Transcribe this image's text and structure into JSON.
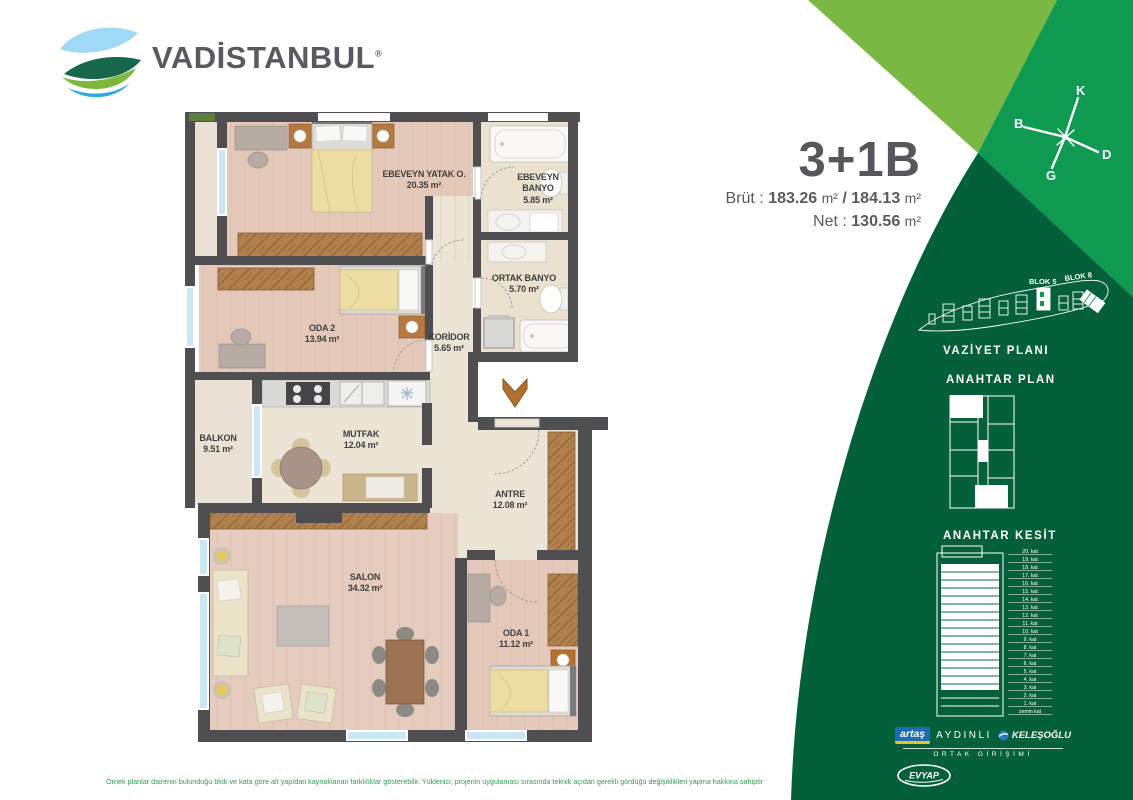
{
  "brand": {
    "name": "VADİSTANBUL",
    "registered": "®"
  },
  "unit": {
    "title": "3+1B",
    "brut_label": "Brüt :",
    "brut_area_1": "183.26",
    "separator": "/",
    "brut_area_2": "184.13",
    "net_label": "Net :",
    "net_area": "130.56",
    "unit_suffix": "m²"
  },
  "compass": {
    "north": "K",
    "east": "D",
    "south": "G",
    "west": "B"
  },
  "site_plan": {
    "heading": "VAZİYET PLANI",
    "blok5": "BLOK 5",
    "blok8": "BLOK 8"
  },
  "key_plan": {
    "heading": "ANAHTAR PLAN"
  },
  "key_section": {
    "heading": "ANAHTAR KESİT",
    "floors": [
      "20. kat",
      "19. kat",
      "18. kat",
      "17. kat",
      "16. kat",
      "15. kat",
      "14. kat",
      "13. kat",
      "12. kat",
      "11. kat",
      "10. kat",
      "9. kat",
      "8. kat",
      "7. kat",
      "6. kat",
      "5. kat",
      "4. kat",
      "3. kat",
      "2. kat",
      "1. kat",
      "zemin kat"
    ]
  },
  "plan": {
    "rooms": [
      {
        "name": "EBEVEYN YATAK O.",
        "area": "20.35 m²"
      },
      {
        "name": "EBEVEYN BANYO",
        "area": "5.85 m²"
      },
      {
        "name": "ORTAK BANYO",
        "area": "5.70 m²"
      },
      {
        "name": "ODA 2",
        "area": "13.94 m²"
      },
      {
        "name": "KORİDOR",
        "area": "5.65 m²"
      },
      {
        "name": "BALKON",
        "area": "9.51 m²"
      },
      {
        "name": "MUTFAK",
        "area": "12.04 m²"
      },
      {
        "name": "ANTRE",
        "area": "12.08 m²"
      },
      {
        "name": "SALON",
        "area": "34.32 m²"
      },
      {
        "name": "ODA 1",
        "area": "11.12 m²"
      }
    ]
  },
  "partners": {
    "artas": "artaş",
    "aydinli": "AYDINLI",
    "kelesoglu": "KELEŞOĞLU",
    "joint": "ORTAK GİRİŞİMİ",
    "evyap": "EVYAP"
  },
  "footer": {
    "disclaimer": "Örnek planlar dairenin bulunduğu blok ve kata göre alt yapıdan kaynaklanan farklılıklar gösterebilir. Yüklenici, projenin uygulaması sırasında teknik açıdan gerekli gördüğü değişiklikleri yapma hakkına sahiptir"
  },
  "colors": {
    "green_light": "#79b943",
    "green_mid": "#0e9a50",
    "green_dark": "#04603a",
    "accent_yellow": "#f2c21b",
    "artas_blue": "#1a6cb8"
  }
}
